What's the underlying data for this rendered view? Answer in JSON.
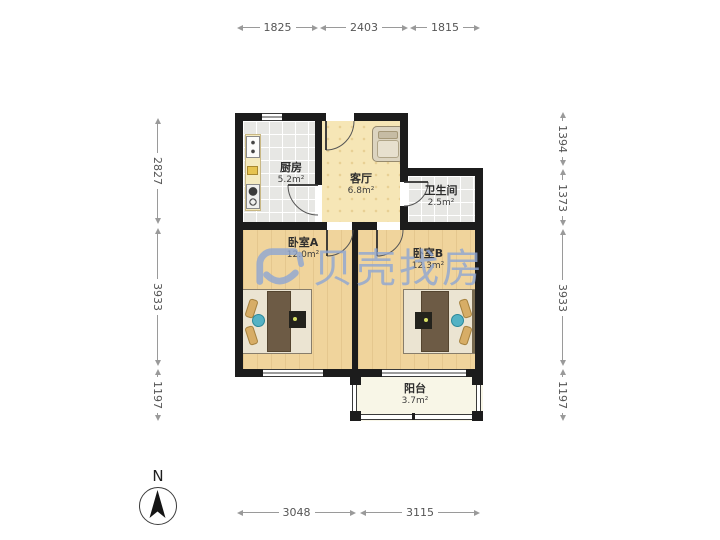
{
  "watermark": {
    "text": "贝壳找房",
    "logo_icon": "beike-shell-logo"
  },
  "compass": {
    "north_label": "N",
    "icon": "north-arrow"
  },
  "rooms": [
    {
      "name": "厨房",
      "area": "5.2m²"
    },
    {
      "name": "客厅",
      "area": "6.8m²"
    },
    {
      "name": "卫生间",
      "area": "2.5m²"
    },
    {
      "name": "卧室A",
      "area": "12.0m²"
    },
    {
      "name": "卧室B",
      "area": "12.3m²"
    },
    {
      "name": "阳台",
      "area": "3.7m²"
    }
  ],
  "dimensions_mm": {
    "top": [
      "1825",
      "2403",
      "1815"
    ],
    "bottom": [
      "3048",
      "3115"
    ],
    "left": [
      "2827",
      "3933",
      "1197"
    ],
    "right": [
      "1394",
      "1373",
      "3933",
      "1197"
    ]
  },
  "colors": {
    "wall": "#1c1c1c",
    "bedroom_floor": "#f0d49c",
    "living_floor": "#f6e6b6",
    "tile_floor": "#e7e7e4",
    "balcony_floor": "#f8f6e7",
    "watermark_blue": "#8ea6d4",
    "blanket_brown": "#6d5b45",
    "accent_teal": "#54b2c4"
  }
}
